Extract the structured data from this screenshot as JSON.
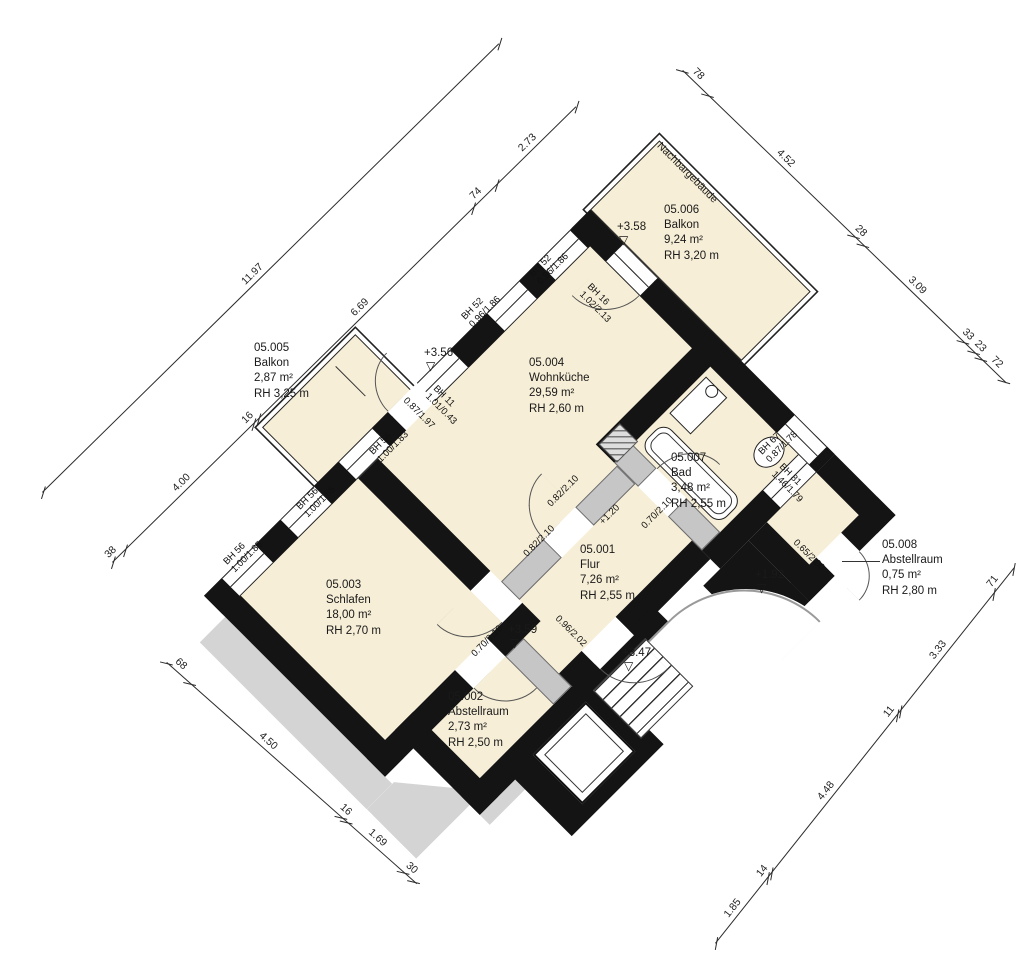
{
  "site": {
    "neighbor_label": "Nachbargebäude"
  },
  "rooms": [
    {
      "id": "05.001",
      "name": "Flur",
      "area": "7,26 m²",
      "height": "RH 2,55 m"
    },
    {
      "id": "05.002",
      "name": "Abstellraum",
      "area": "2,73 m²",
      "height": "RH 2,50 m"
    },
    {
      "id": "05.003",
      "name": "Schlafen",
      "area": "18,00 m²",
      "height": "RH 2,70 m"
    },
    {
      "id": "05.004",
      "name": "Wohnküche",
      "area": "29,59 m²",
      "height": "RH 2,60 m"
    },
    {
      "id": "05.005",
      "name": "Balkon",
      "area": "2,87 m²",
      "height": "RH 3,25 m"
    },
    {
      "id": "05.006",
      "name": "Balkon",
      "area": "9,24 m²",
      "height": "RH 3,20 m"
    },
    {
      "id": "05.007",
      "name": "Bad",
      "area": "3,48 m²",
      "height": "RH 2,55 m"
    },
    {
      "id": "05.008",
      "name": "Abstellraum",
      "area": "0,75 m²",
      "height": "RH 2,80 m"
    }
  ],
  "levels": [
    {
      "label": "+3.58"
    },
    {
      "label": "+3.56"
    },
    {
      "label": "+3.59"
    },
    {
      "label": "+3.47"
    },
    {
      "label": "+1.92"
    },
    {
      "label": "+1.20"
    }
  ],
  "openings": {
    "windows": [
      {
        "id": "BH 56",
        "size": "1.00/1.85"
      },
      {
        "id": "BH 56",
        "size": "1.00/1.85"
      },
      {
        "id": "BH 56",
        "size": "1.00/1.83"
      },
      {
        "id": "BH 11",
        "size": "1.01/0.43"
      },
      {
        "id": "BH 52",
        "size": "0.96/1.86"
      },
      {
        "id": "BH 52",
        "size": "0.96/1.86"
      },
      {
        "id": "BH 16",
        "size": "1.02/2.13"
      },
      {
        "id": "BH 67",
        "size": "0.87/1.78"
      },
      {
        "id": "BH 81",
        "size": "1.46/1.79"
      }
    ],
    "doors": [
      "0.87/1.97",
      "0.82/2.10",
      "0.82/2.10",
      "0.70/2.10",
      "0.70/2.10",
      "0.96/2.02",
      "0.65/2.00"
    ]
  },
  "dimensions": [
    {
      "x": 42,
      "y": 492,
      "angle": -44.5,
      "len": 640,
      "ticks": [
        0,
        640
      ],
      "labels": [
        {
          "t": "11.97",
          "at": 290
        }
      ]
    },
    {
      "x": 112,
      "y": 562,
      "angle": -44.5,
      "len": 650,
      "ticks": [
        0,
        17,
        197,
        204,
        505,
        538,
        650
      ],
      "labels": [
        {
          "t": "38",
          "at": 0
        },
        {
          "t": "4.00",
          "at": 95
        },
        {
          "t": "16",
          "at": 192
        },
        {
          "t": "6.69",
          "at": 345
        },
        {
          "t": "74",
          "at": 512
        },
        {
          "t": "2.73",
          "at": 580
        }
      ]
    },
    {
      "x": 683,
      "y": 70,
      "angle": 44,
      "len": 450,
      "ticks": [
        0,
        35,
        238,
        251,
        390,
        405,
        415,
        447
      ],
      "labels": [
        {
          "t": "78",
          "at": 8
        },
        {
          "t": "4.52",
          "at": 125
        },
        {
          "t": "28",
          "at": 234
        },
        {
          "t": "3.09",
          "at": 308
        },
        {
          "t": "33",
          "at": 383
        },
        {
          "t": "23",
          "at": 400
        },
        {
          "t": "72",
          "at": 423
        }
      ]
    },
    {
      "x": 715,
      "y": 943,
      "angle": -51.5,
      "len": 480,
      "ticks": [
        0,
        83,
        89,
        291,
        296,
        446,
        478
      ],
      "labels": [
        {
          "t": "1.85",
          "at": 28
        },
        {
          "t": "14",
          "at": 80
        },
        {
          "t": "4.48",
          "at": 178
        },
        {
          "t": "11",
          "at": 284
        },
        {
          "t": "3.33",
          "at": 358
        },
        {
          "t": "71",
          "at": 450
        }
      ]
    },
    {
      "x": 167,
      "y": 662,
      "angle": 41.5,
      "len": 334,
      "ticks": [
        0,
        31,
        233,
        240,
        316,
        330
      ],
      "labels": [
        {
          "t": "68",
          "at": 6
        },
        {
          "t": "4.50",
          "at": 118
        },
        {
          "t": "16",
          "at": 226
        },
        {
          "t": "1.69",
          "at": 264
        },
        {
          "t": "30",
          "at": 314
        }
      ]
    }
  ]
}
